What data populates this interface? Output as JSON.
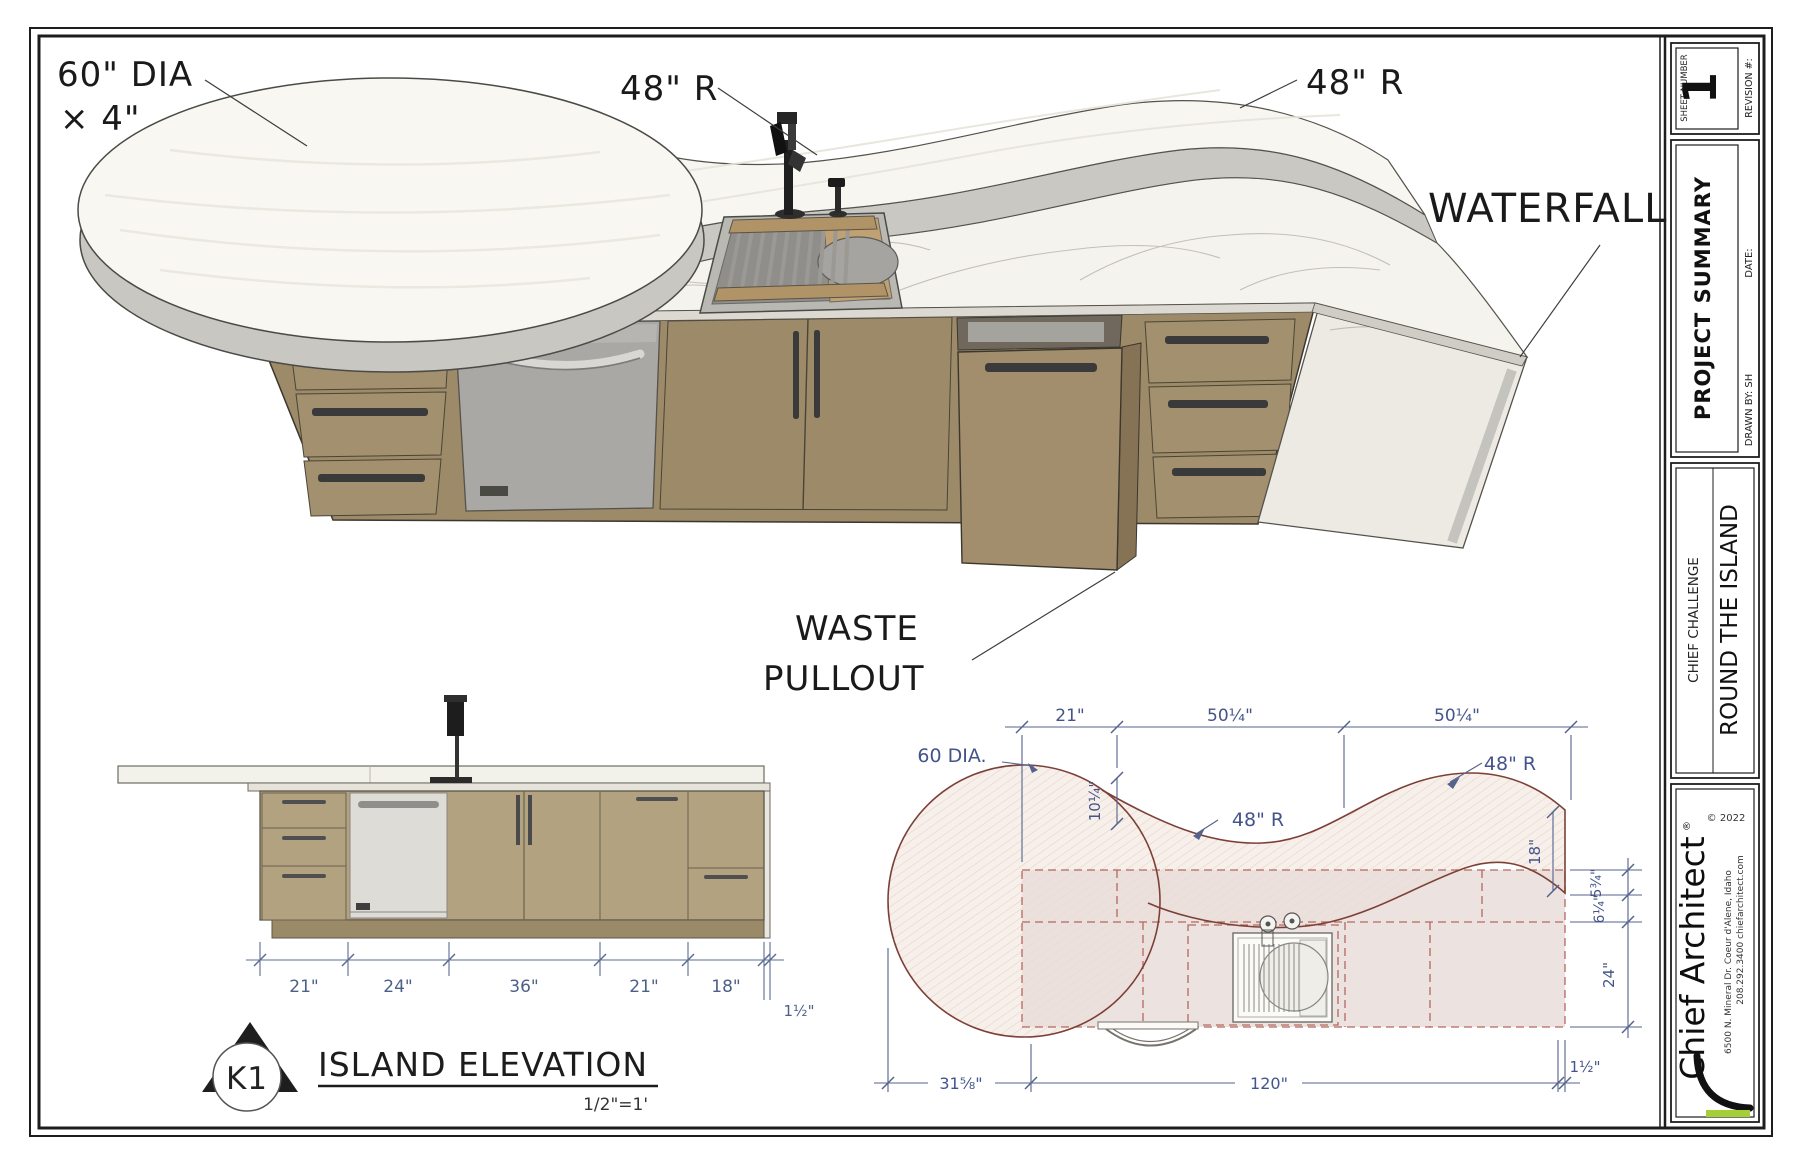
{
  "colors": {
    "accent_green": "#a6ce39",
    "dim_blue": "#4d5f88",
    "plan_red": "#7d4038",
    "wood": "#9d8a69",
    "elev_wood": "#b2a27f"
  },
  "titleblock": {
    "sheet_number_label": "SHEET NUMBER",
    "sheet_number": "1",
    "revision_label": "REVISION #:",
    "summary_title": "PROJECT SUMMARY",
    "date_label": "DATE:",
    "drawn_by": "DRAWN BY: SH",
    "challenge": "CHIEF CHALLENGE",
    "project_name": "ROUND THE ISLAND",
    "copyright": "© 2022",
    "brand": "Chief Architect",
    "brand_reg": "®",
    "address": "6500 N. Mineral Dr.  Coeur d'Alene,  Idaho",
    "contact": "208.292.3400        chiefarchitect.com"
  },
  "view3d": {
    "dia": "60\" DIA",
    "dia_x": "× 4\"",
    "r_left": "48\" R",
    "r_right": "48\" R",
    "waterfall": "WATERFALL",
    "waste_1": "WASTE",
    "waste_2": "PULLOUT"
  },
  "elevation": {
    "callout": "K1",
    "title": "ISLAND ELEVATION",
    "scale": "1/2\"=1'",
    "dims": [
      "21\"",
      "24\"",
      "36\"",
      "21\"",
      "18\""
    ],
    "dim_overhang": "1½\""
  },
  "plan": {
    "label_dia": "60 DIA.",
    "r1": "48\" R",
    "r2": "48\" R",
    "v10": "10¼\"",
    "top_dims": [
      "21\"",
      "50¼\"",
      "50¼\""
    ],
    "d18": "18\"",
    "d5": "5¾\"",
    "d6": "6¼\"",
    "d24": "24\"",
    "d1_right": "1½\"",
    "d31": "31⅝\"",
    "d120": "120\""
  }
}
